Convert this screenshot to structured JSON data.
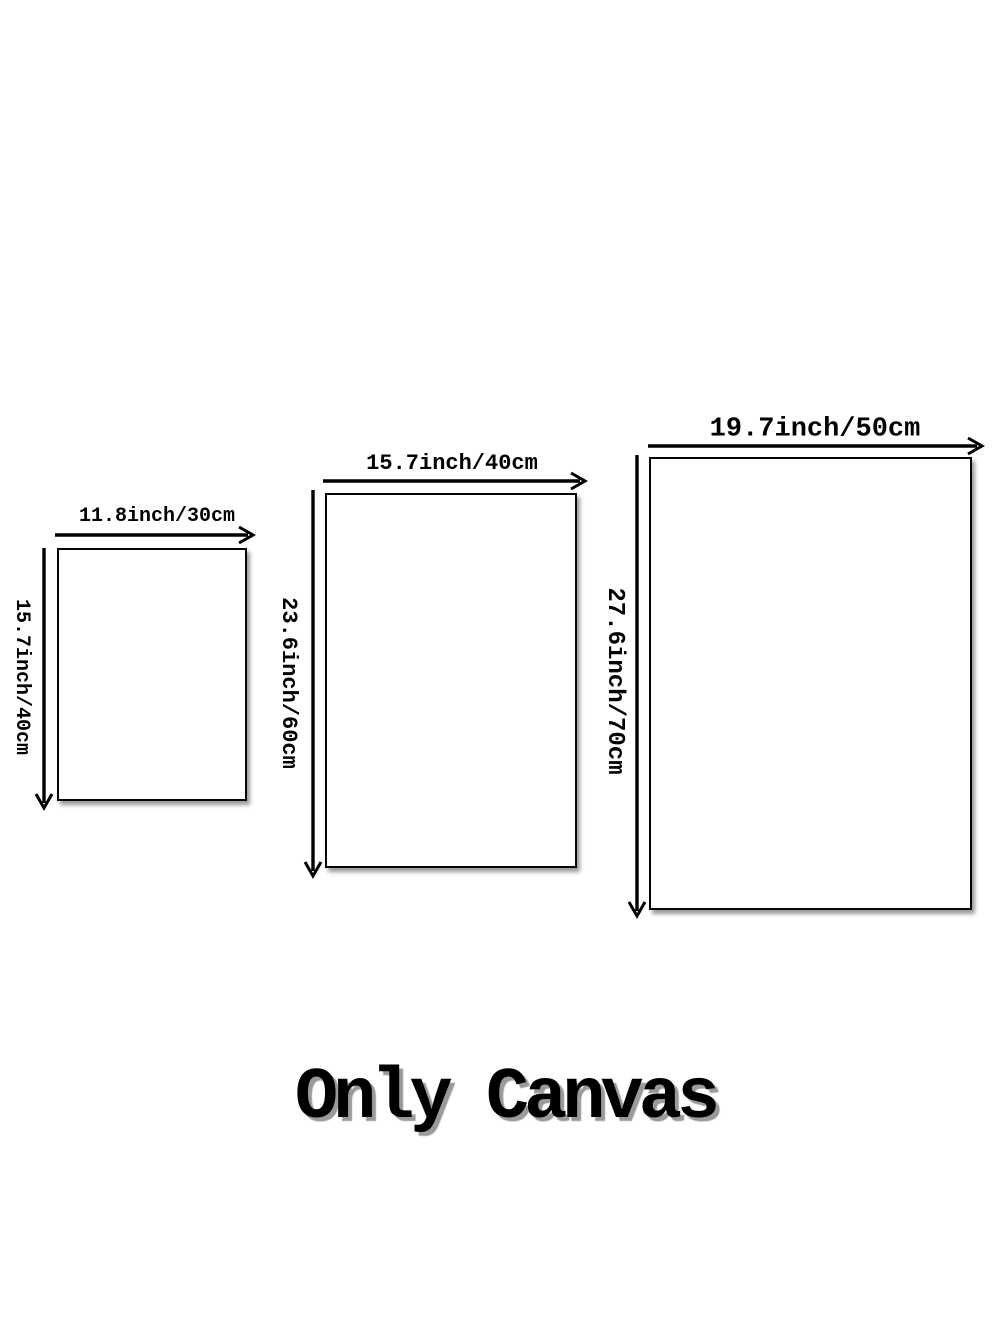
{
  "caption": "Only Canvas",
  "colors": {
    "background": "#ffffff",
    "line": "#000000",
    "caption_shadow": "#9a9a9a"
  },
  "canvases": [
    {
      "size_name": "small",
      "width_label": "11.8inch/30cm",
      "height_label": "15.7inch/40cm"
    },
    {
      "size_name": "medium",
      "width_label": "15.7inch/40cm",
      "height_label": "23.6inch/60cm"
    },
    {
      "size_name": "large",
      "width_label": "19.7inch/50cm",
      "height_label": "27.6inch/70cm"
    }
  ]
}
